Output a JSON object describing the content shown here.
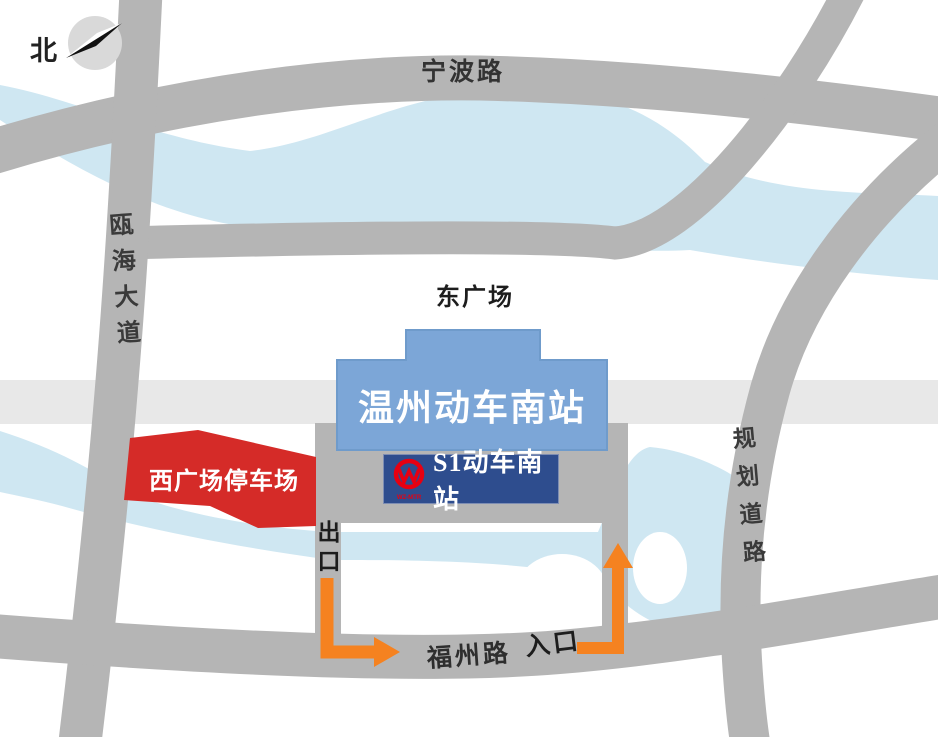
{
  "compass": {
    "north_label": "北"
  },
  "roads": {
    "ningbo": {
      "label": "宁波路"
    },
    "ouhai": {
      "label": "瓯海大道"
    },
    "guihua": {
      "label": "规划道路"
    },
    "fuzhou": {
      "label": "福州路"
    }
  },
  "squares": {
    "east_label": "东广场"
  },
  "station": {
    "name": "温州动车南站"
  },
  "metro": {
    "label": "S1动车南站",
    "logo_subtext": "WZ-MTR"
  },
  "parking": {
    "label": "西广场停车场"
  },
  "gates": {
    "exit_label": "出口",
    "entrance_label": "入口"
  },
  "colors": {
    "road": "#b5b5b5",
    "road_light": "#e8e8e8",
    "water": "#cfe7f2",
    "station_blue": "#7ca6d7",
    "station_blue_border": "#6f9bcb",
    "metro_blue": "#2e4d8e",
    "parking_red": "#d52b28",
    "arrow_orange": "#f58220",
    "logo_red": "#e60012",
    "compass_gray": "#d9d9d9"
  }
}
